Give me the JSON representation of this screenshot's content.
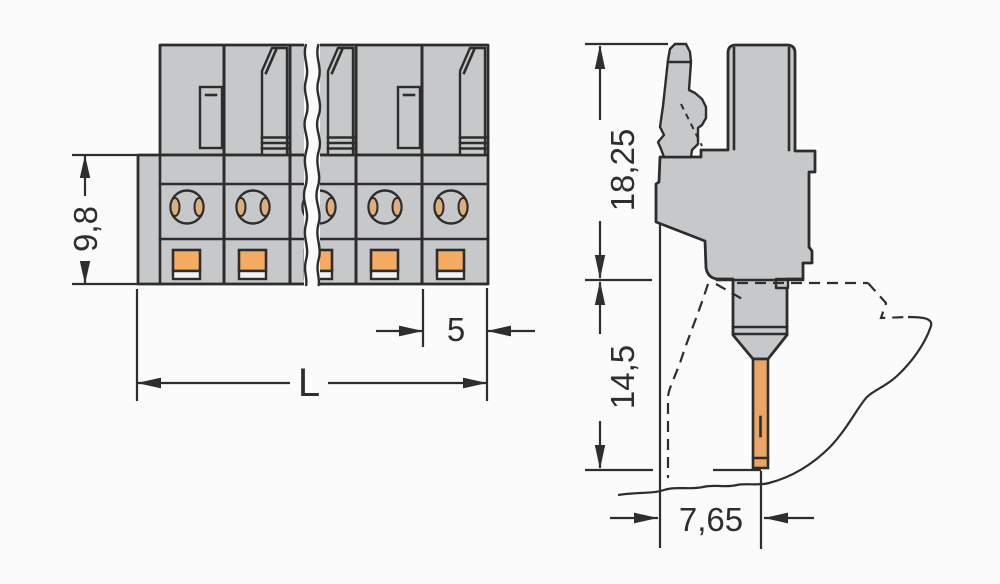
{
  "drawing": {
    "front_view": {
      "height_dim": "9,8",
      "pitch_dim": "5",
      "length_dim": "L"
    },
    "side_view": {
      "height_dim": "18,25",
      "depth_dim": "14,5",
      "pin_offset_dim": "7,65"
    },
    "colors": {
      "housing": "#c6c8ca",
      "contact_orange": "#f5ab62",
      "pin_copper": "#e9a566",
      "line": "#2d2d2d",
      "background": "#fbfbfb"
    }
  }
}
